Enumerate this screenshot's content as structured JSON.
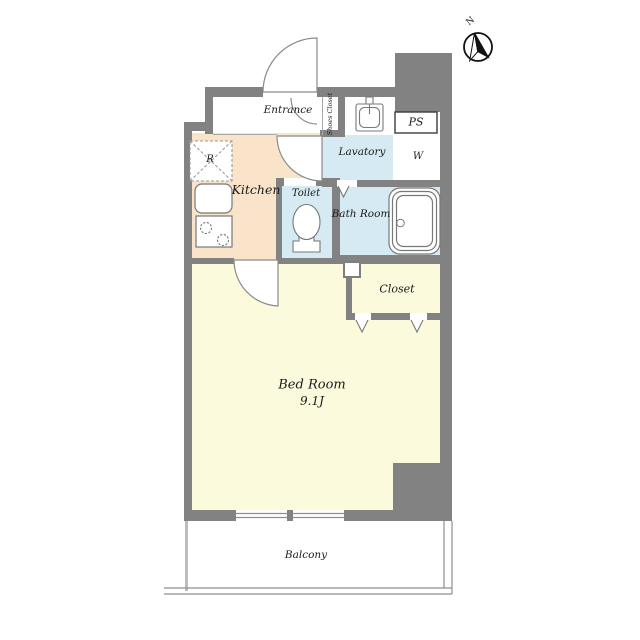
{
  "title": "Studio apartment floor plan (1K)",
  "colors": {
    "wall": "#828282",
    "kitchen_floor": "#f9e4c9",
    "wet_floor": "#d5eaf2",
    "bedroom_floor": "#fbfadc",
    "closet_floor": "#dcc294",
    "fixture_line": "#787878",
    "door_line": "#8a8a8a",
    "text": "#1b1b1b",
    "compass_ink": "#121212",
    "balcony_line": "#8f8f8f"
  },
  "compass": {
    "north_label": "N"
  },
  "rooms": {
    "entrance": {
      "label": "Entrance"
    },
    "shoes_closet": {
      "label": "Shoes Closet"
    },
    "ps": {
      "label": "PS"
    },
    "lavatory": {
      "label": "Lavatory"
    },
    "kitchen": {
      "label": "Kitchen"
    },
    "toilet": {
      "label": "Toilet"
    },
    "bath": {
      "label": "Bath Room"
    },
    "closet": {
      "label": "Closet"
    },
    "bedroom": {
      "label": "Bed Room",
      "size": "9.1J"
    },
    "balcony": {
      "label": "Balcony"
    }
  },
  "appliance_marks": {
    "refrigerator": {
      "label": "R"
    },
    "washer": {
      "label": "W"
    }
  }
}
